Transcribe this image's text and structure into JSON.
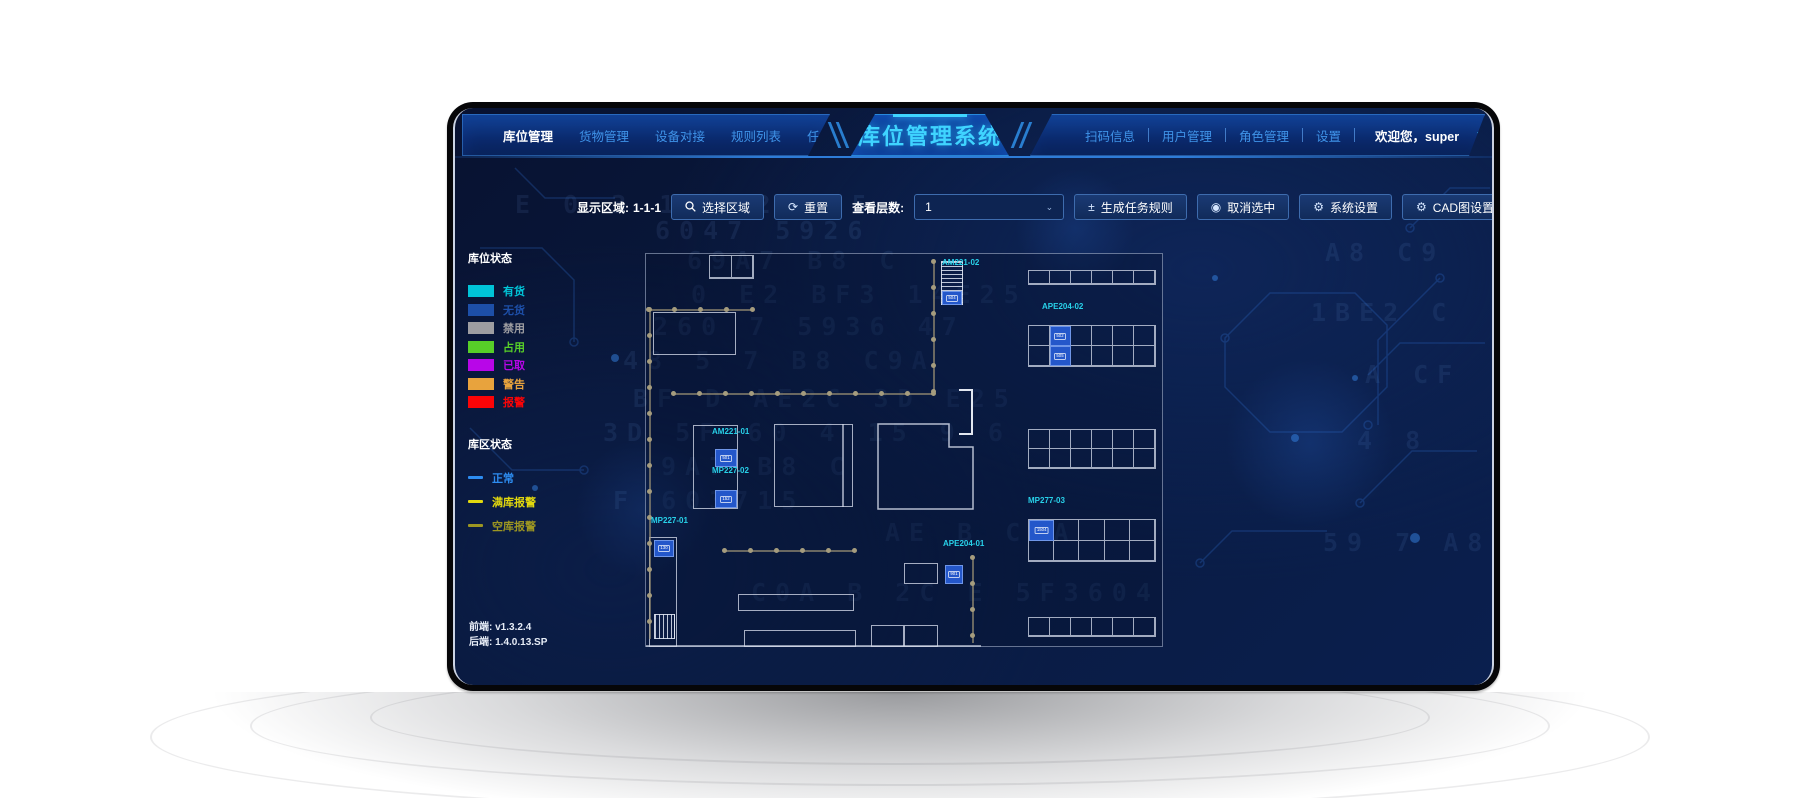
{
  "nav": {
    "title": "库位管理系统",
    "left_tabs": [
      {
        "label": "库位管理",
        "active": true
      },
      {
        "label": "货物管理",
        "active": false
      },
      {
        "label": "设备对接",
        "active": false
      },
      {
        "label": "规则列表",
        "active": false
      },
      {
        "label": "任务列表",
        "active": false
      }
    ],
    "right_tabs": [
      {
        "label": "扫码信息"
      },
      {
        "label": "用户管理"
      },
      {
        "label": "角色管理"
      },
      {
        "label": "设置"
      }
    ],
    "welcome": "欢迎您，super",
    "caret": "▼"
  },
  "toolbar": {
    "display_area_label": "显示区域:",
    "display_area_value": "1-1-1",
    "select_area": "选择区域",
    "reset": "重置",
    "reset_icon": "⟳",
    "view_layers_label": "查看层数:",
    "view_layers_value": "1",
    "select_caret": "⌄",
    "generate_task_rule": "生成任务规则",
    "generate_icon": "±",
    "cancel_selection": "取消选中",
    "cancel_icon": "◉",
    "system_settings": "系统设置",
    "gear_icon": "⚙",
    "cad_settings": "CAD图设置",
    "upload_file": "上传文件",
    "upload_icon": "↥"
  },
  "legend": {
    "slot_status_title": "库位状态",
    "slot_statuses": [
      {
        "label": "有货",
        "color": "#00c4d8"
      },
      {
        "label": "无货",
        "color": "#1d4fa8"
      },
      {
        "label": "禁用",
        "color": "#9d9da1"
      },
      {
        "label": "占用",
        "color": "#57ce28"
      },
      {
        "label": "已取",
        "color": "#b806e8"
      },
      {
        "label": "警告",
        "color": "#e8a33d"
      },
      {
        "label": "报警",
        "color": "#fb0407"
      }
    ],
    "zone_status_title": "库区状态",
    "zone_statuses": [
      {
        "label": "正常",
        "color": "#2d8cf0"
      },
      {
        "label": "满库报警",
        "color": "#e2d80e"
      },
      {
        "label": "空库报警",
        "color": "#9c9622"
      }
    ]
  },
  "versions": {
    "frontend_label": "前端:",
    "frontend_value": "v1.3.2.4",
    "backend_label": "后端:",
    "backend_value": "1.4.0.13.SP"
  },
  "map": {
    "racks": [
      {
        "x": 382,
        "y": 16,
        "w": 128,
        "h": 15,
        "rows": 1,
        "cols": 6,
        "blue": []
      },
      {
        "x": 382,
        "y": 71,
        "w": 128,
        "h": 42,
        "rows": 2,
        "cols": 6,
        "blue": [
          [
            0,
            1,
            "502"
          ],
          [
            1,
            1,
            "505"
          ]
        ]
      },
      {
        "x": 382,
        "y": 175,
        "w": 128,
        "h": 40,
        "rows": 2,
        "cols": 6,
        "blue": []
      },
      {
        "x": 382,
        "y": 265,
        "w": 128,
        "h": 43,
        "rows": 2,
        "cols": 5,
        "blue": [
          [
            0,
            0,
            "1504"
          ]
        ]
      },
      {
        "x": 382,
        "y": 363,
        "w": 128,
        "h": 20,
        "rows": 1,
        "cols": 6,
        "blue": []
      },
      {
        "x": 63,
        "y": 1,
        "w": 45,
        "h": 24,
        "rows": 1,
        "cols": 2,
        "blue": []
      }
    ],
    "striped": [
      {
        "x": 295,
        "y": 7,
        "w": 22,
        "h": 44,
        "dir": "h",
        "blue": {
          "y": 29,
          "h": 14,
          "code": "504"
        }
      },
      {
        "x": 8,
        "y": 360,
        "w": 21,
        "h": 25,
        "dir": "v"
      }
    ],
    "rooms": [
      {
        "x": 7,
        "y": 58,
        "w": 83,
        "h": 43
      },
      {
        "x": 47,
        "y": 171,
        "w": 45,
        "h": 84
      },
      {
        "x": 128,
        "y": 170,
        "w": 79,
        "h": 83
      },
      {
        "x": 3,
        "y": 283,
        "w": 28,
        "h": 110
      },
      {
        "x": 258,
        "y": 309,
        "w": 34,
        "h": 21
      },
      {
        "x": 92,
        "y": 340,
        "w": 116,
        "h": 17
      },
      {
        "x": 98,
        "y": 376,
        "w": 112,
        "h": 17
      },
      {
        "x": 225,
        "y": 371,
        "w": 33,
        "h": 22
      },
      {
        "x": 258,
        "y": 371,
        "w": 34,
        "h": 22
      }
    ],
    "polygon": "232,170 303,170 303,193 327,193 327,255 232,255",
    "lines": [
      [
        197,
        170,
        197,
        253
      ],
      [
        0,
        392,
        335,
        392
      ]
    ],
    "bracket": {
      "x": 313,
      "y": 135,
      "w": 14,
      "h": 46
    },
    "paths": [
      {
        "dir": "h",
        "x": 2,
        "y": 55,
        "len": 106
      },
      {
        "dir": "v",
        "x": 3,
        "y": 55,
        "len": 330
      },
      {
        "dir": "h",
        "x": 27,
        "y": 139,
        "len": 260
      },
      {
        "dir": "v",
        "x": 287,
        "y": 7,
        "len": 132
      },
      {
        "dir": "h",
        "x": 78,
        "y": 296,
        "len": 130
      },
      {
        "dir": "v",
        "x": 326,
        "y": 303,
        "len": 86
      }
    ],
    "labels": [
      {
        "t": "AM221-02",
        "x": 296,
        "y": 13
      },
      {
        "t": "APE204-02",
        "x": 396,
        "y": 57
      },
      {
        "t": "AM221-01",
        "x": 66,
        "y": 182
      },
      {
        "t": "MP227-02",
        "x": 66,
        "y": 221
      },
      {
        "t": "MP227-01",
        "x": 5,
        "y": 271
      },
      {
        "t": "APE204-01",
        "x": 297,
        "y": 294
      },
      {
        "t": "MP277-03",
        "x": 382,
        "y": 251
      }
    ],
    "cells": [
      {
        "code": "501",
        "x": 69,
        "y": 195,
        "w": 22,
        "h": 18
      },
      {
        "code": "152",
        "x": 69,
        "y": 236,
        "w": 22,
        "h": 18
      },
      {
        "code": "130",
        "x": 8,
        "y": 286,
        "w": 20,
        "h": 17
      },
      {
        "code": "901",
        "x": 299,
        "y": 311,
        "w": 18,
        "h": 19
      }
    ]
  },
  "bg_rows": [
    {
      "x": 200,
      "y": 108,
      "t": "6047 5926"
    },
    {
      "x": 232,
      "y": 138,
      "t": "69A7  B8  C"
    },
    {
      "x": 236,
      "y": 172,
      "t": "0 E2 BF3 14E25"
    },
    {
      "x": 198,
      "y": 204,
      "t": "260 7 5936 47"
    },
    {
      "x": 168,
      "y": 238,
      "t": "48 5  7  B8  C9A"
    },
    {
      "x": 178,
      "y": 276,
      "t": "BF  D  AE2C 3D E25"
    },
    {
      "x": 148,
      "y": 310,
      "t": "3D 5F 60 4 15 9 6"
    },
    {
      "x": 206,
      "y": 344,
      "t": "9A7  B8  C"
    },
    {
      "x": 158,
      "y": 378,
      "t": "F 603715"
    },
    {
      "x": 430,
      "y": 410,
      "t": "AE  B  C A"
    },
    {
      "x": 296,
      "y": 470,
      "t": "C0A  B 2C  E 5F3604"
    },
    {
      "x": 60,
      "y": 82,
      "t": "E 0 3 1 4 2 3 5"
    },
    {
      "x": 870,
      "y": 130,
      "t": "A8  C9"
    },
    {
      "x": 856,
      "y": 190,
      "t": "1BE2 C"
    },
    {
      "x": 910,
      "y": 252,
      "t": "A  CF"
    },
    {
      "x": 902,
      "y": 318,
      "t": "4 8"
    },
    {
      "x": 868,
      "y": 420,
      "t": "59 7 A8"
    }
  ]
}
